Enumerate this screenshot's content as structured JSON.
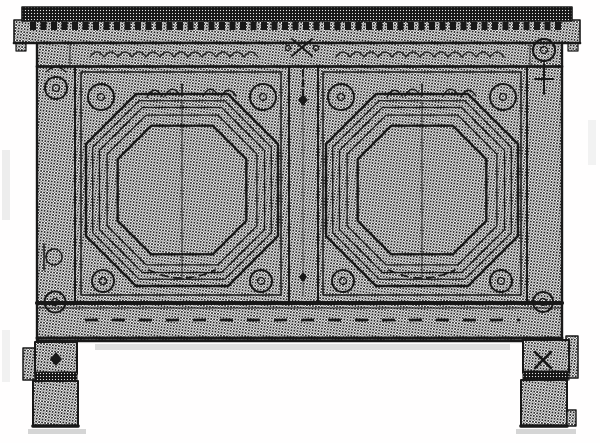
{
  "figure": {
    "alt": "Black-and-white halftone engraving of an antique joined chest: a dentilled cornice cap, carved scroll frieze, two large octagonal molded panels with rosette bosses in the corners, circular rosettes on the stiles, a carved bottom rail with dash ornament, and four square block feet with the rear feet just visible at the sides.",
    "palette": {
      "ink": "#181818",
      "paper": "#ffffff",
      "halftone_tone": "#8a8a8a",
      "shadow": "#d5d5d5"
    }
  }
}
